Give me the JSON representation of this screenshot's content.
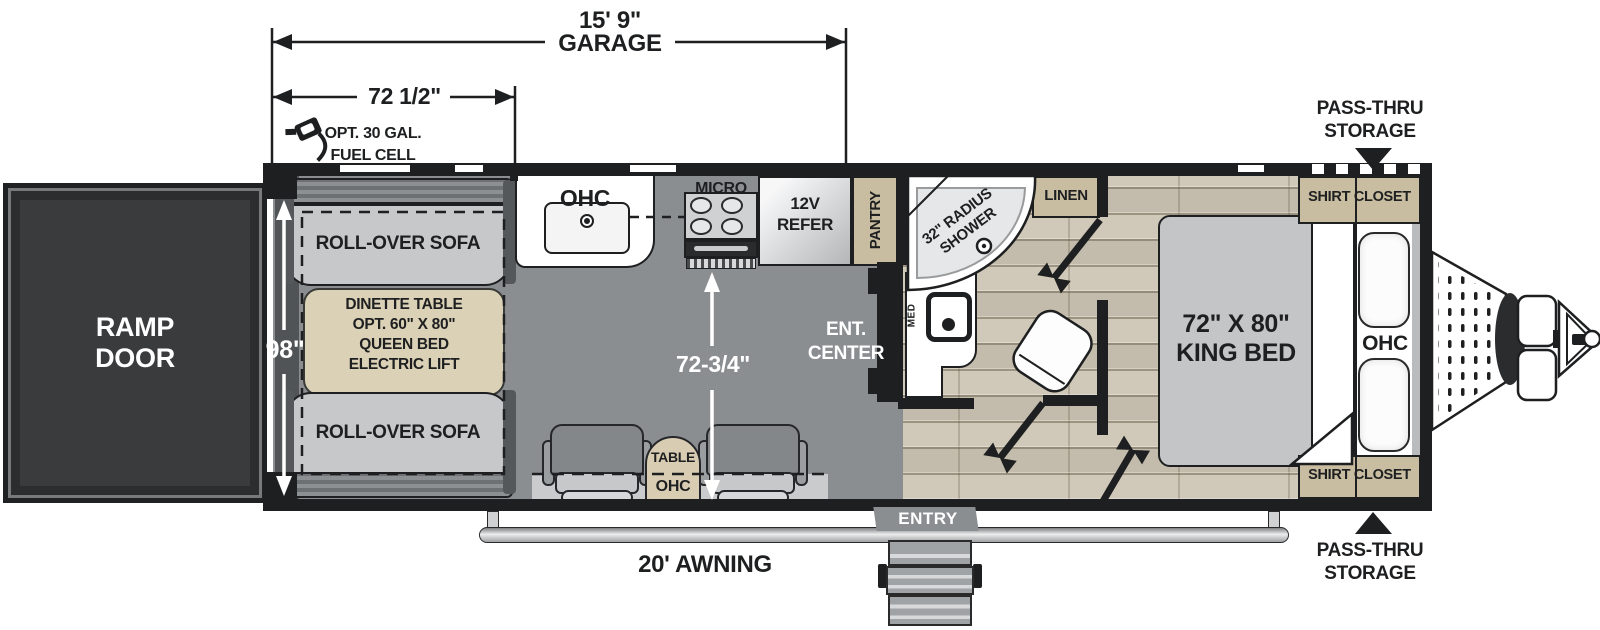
{
  "dims": {
    "garage_len": "15' 9\"",
    "garage_word": "GARAGE",
    "garage_sub": "72 1/2\"",
    "body_width": "98\"",
    "interior_width": "72-3/4\""
  },
  "exterior": {
    "ramp_line1": "RAMP",
    "ramp_line2": "DOOR",
    "awning": "20' AWNING",
    "entry": "ENTRY",
    "pass_thru_line1": "PASS-THRU",
    "pass_thru_line2": "STORAGE",
    "fuel_line1": "OPT. 30 GAL.",
    "fuel_line2": "FUEL CELL"
  },
  "garage": {
    "sofa_front": "ROLL-OVER SOFA",
    "sofa_rear": "ROLL-OVER SOFA",
    "dinette_l1": "DINETTE TABLE",
    "dinette_l2": "OPT. 60\" X 80\"",
    "dinette_l3": "QUEEN BED",
    "dinette_l4": "ELECTRIC LIFT",
    "table": "TABLE",
    "table_ohc": "OHC"
  },
  "kitchen": {
    "ohc": "OHC",
    "micro": "MICRO",
    "refer_l1": "12V",
    "refer_l2": "REFER",
    "pantry": "PANTRY",
    "ent_l1": "ENT.",
    "ent_l2": "CENTER"
  },
  "bath": {
    "shower_l1": "32\" RADIUS",
    "shower_l2": "SHOWER",
    "linen": "LINEN",
    "med": "MED"
  },
  "bedroom": {
    "bed_l1": "72\" X 80\"",
    "bed_l2": "KING BED",
    "ohc": "OHC",
    "closet_front": "SHIRT CLOSET",
    "closet_rear": "SHIRT CLOSET"
  },
  "colors": {
    "wall": "#1e1f20",
    "garage_floor": "#8b8e90",
    "wood_floor": "#ccc4b4",
    "cabinet_tan": "#c8bca1",
    "accent_white": "#ffffff"
  }
}
